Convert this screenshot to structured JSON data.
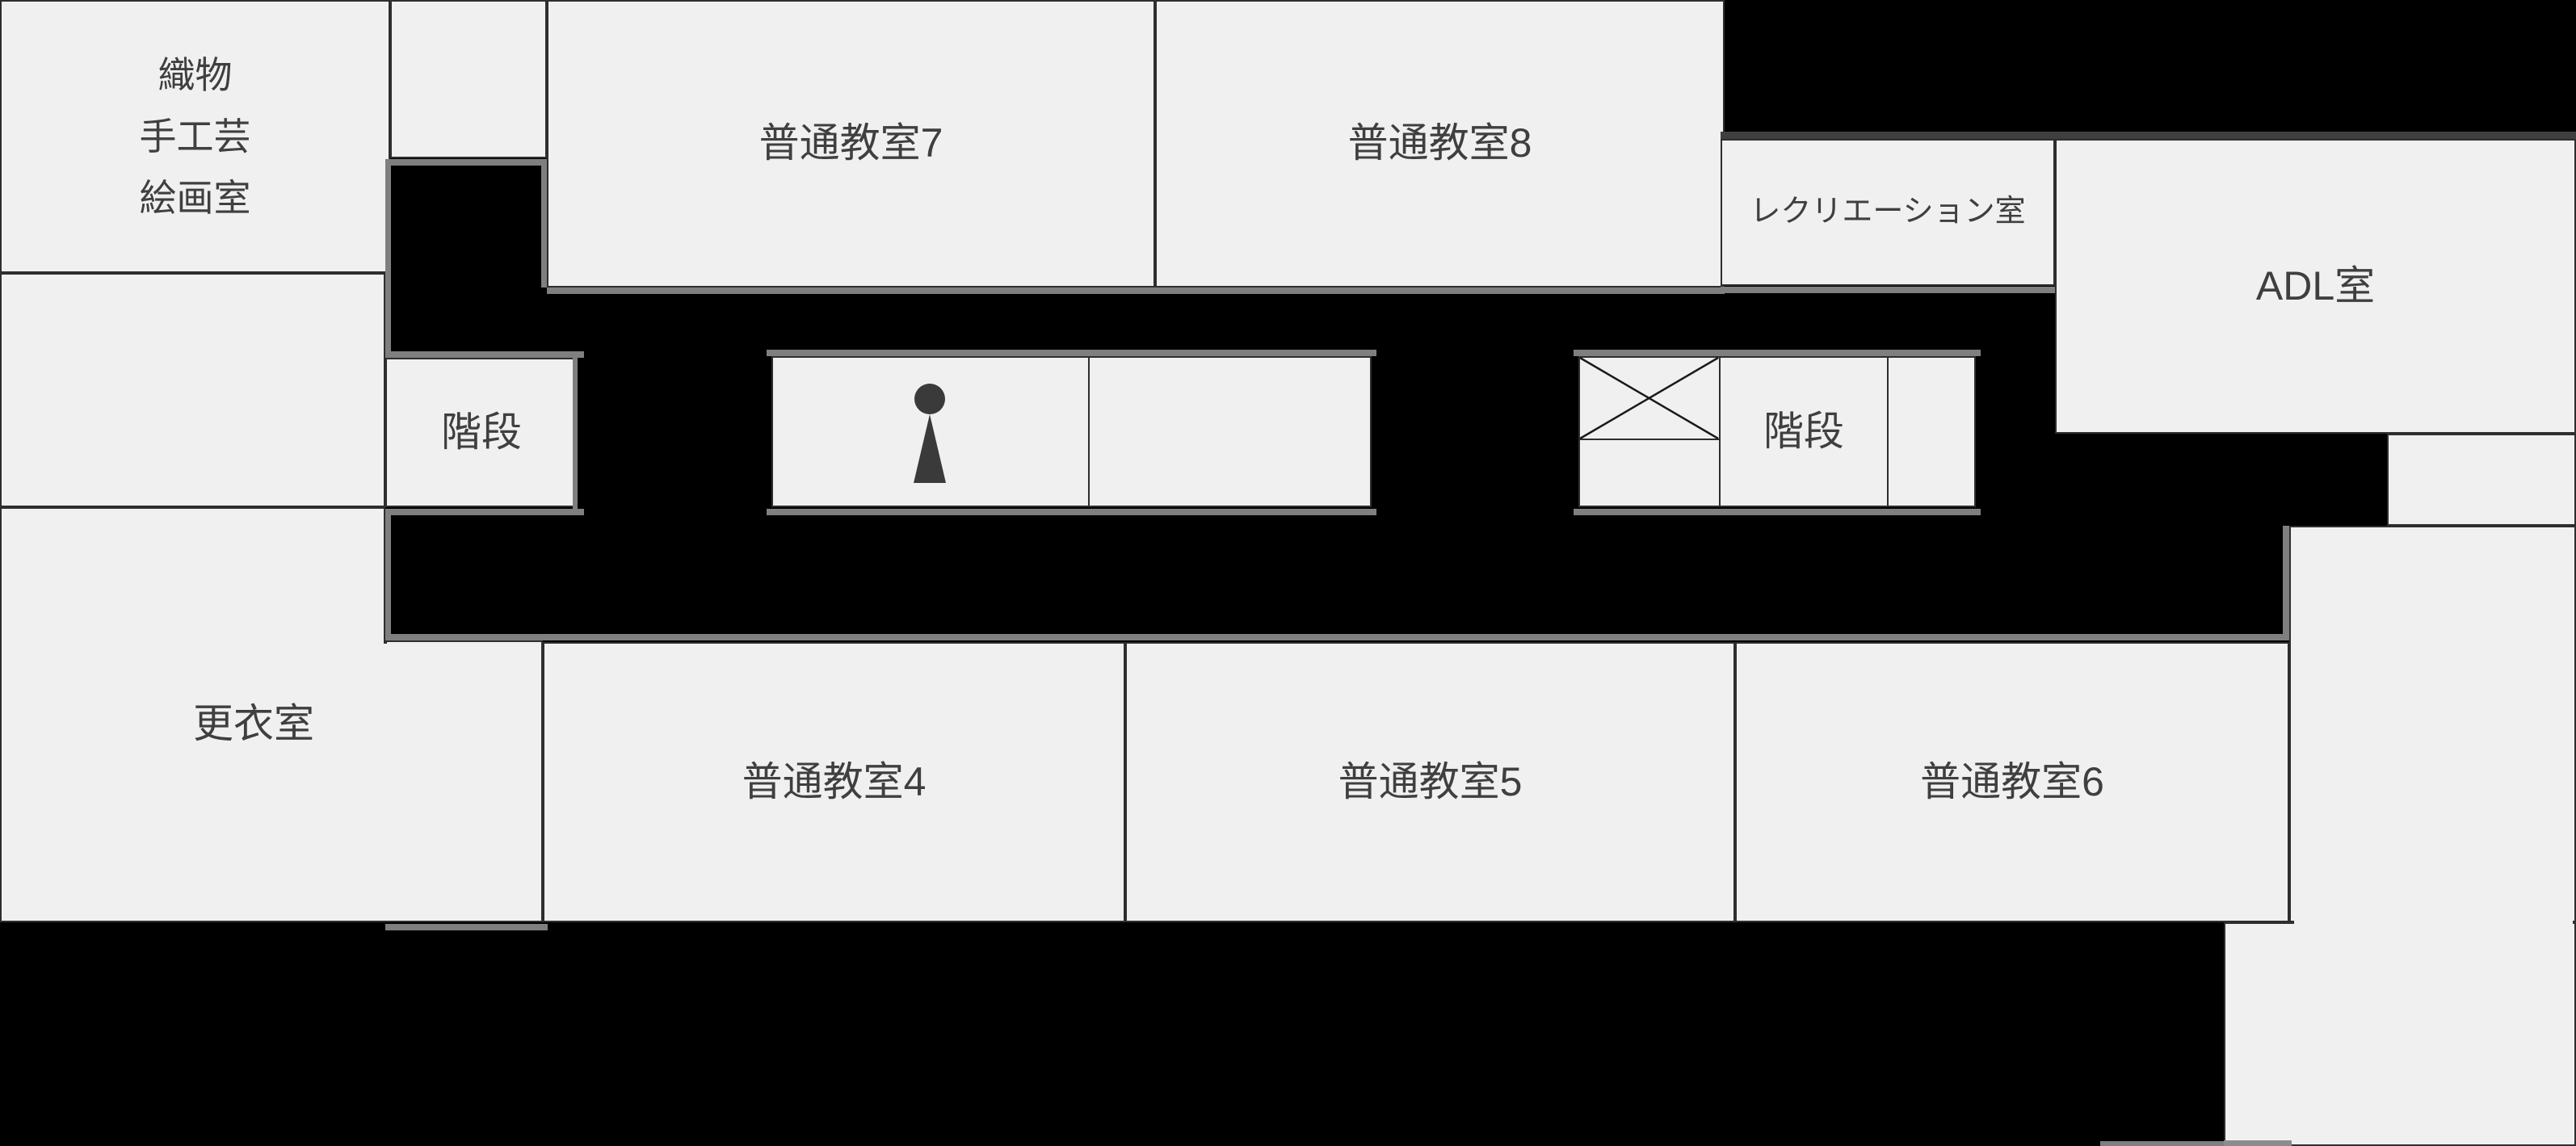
{
  "floorplan": {
    "rooms": {
      "craft_room": {
        "lines": [
          "織物",
          "手工芸",
          "絵画室"
        ]
      },
      "classroom7": {
        "label": "普通教室7"
      },
      "classroom8": {
        "label": "普通教室8"
      },
      "recreation": {
        "label": "レクリエーション室"
      },
      "adl": {
        "label": "ADL室"
      },
      "stairs_left": {
        "label": "階段"
      },
      "stairs_right": {
        "label": "階段"
      },
      "changing_room": {
        "label": "更衣室"
      },
      "classroom4": {
        "label": "普通教室4"
      },
      "classroom5": {
        "label": "普通教室5"
      },
      "classroom6": {
        "label": "普通教室6"
      }
    },
    "icons": {
      "toilet": "person-icon",
      "elevator": "crossed-box-icon"
    },
    "colors": {
      "room_fill": "#f0f0f0",
      "wall": "#2e2e2e",
      "corridor": "#000000",
      "edge_highlight": "#7f7f7f",
      "edge_shadow": "#3f3f3f",
      "label_text": "#3f3f3f",
      "icon": "#3a3a3a"
    }
  }
}
